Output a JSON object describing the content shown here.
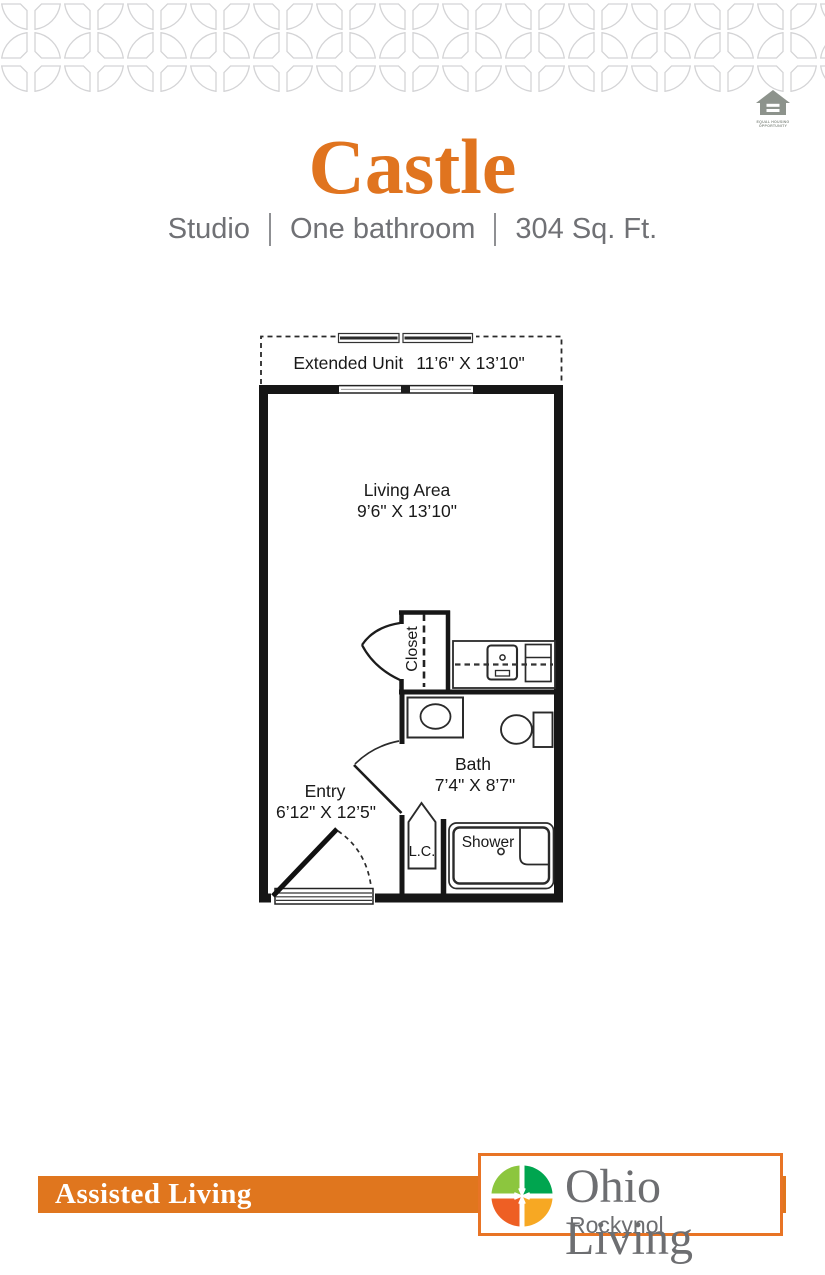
{
  "page": {
    "background": "#ffffff"
  },
  "pattern_band": {
    "color": "#d4d4d6"
  },
  "equal_housing_logo": {
    "color": "#8d938c",
    "caption_line1": "EQUAL HOUSING",
    "caption_line2": "OPPORTUNITY"
  },
  "header": {
    "title": "Castle",
    "title_color": "#e0741f",
    "subtitle_parts": [
      "Studio",
      "One bathroom",
      "304 Sq. Ft."
    ],
    "subtitle_color": "#707175"
  },
  "floor_plan": {
    "extended_unit": {
      "label": "Extended Unit",
      "dims": "11’6\" X 13’10\""
    },
    "living_area": {
      "label": "Living Area",
      "dims": "9’6\" X 13’10\""
    },
    "closet": {
      "label": "Closet"
    },
    "bath": {
      "label": "Bath",
      "dims": "7’4\" X 8’7\""
    },
    "entry": {
      "label": "Entry",
      "dims": "6’12\" X 12’5\""
    },
    "linen_closet": {
      "label": "L.C."
    },
    "shower": {
      "label": "Shower"
    }
  },
  "footer": {
    "band_label": "Assisted Living",
    "band_color": "#e0761e",
    "logo": {
      "title": "Ohio Living",
      "subtitle": "Rockynol",
      "text_color": "#6d6e71",
      "quadrant_colors": {
        "top_left": "#8cc63e",
        "top_right": "#00a54f",
        "bottom_left": "#ee5f24",
        "bottom_right": "#f7a823"
      }
    }
  }
}
